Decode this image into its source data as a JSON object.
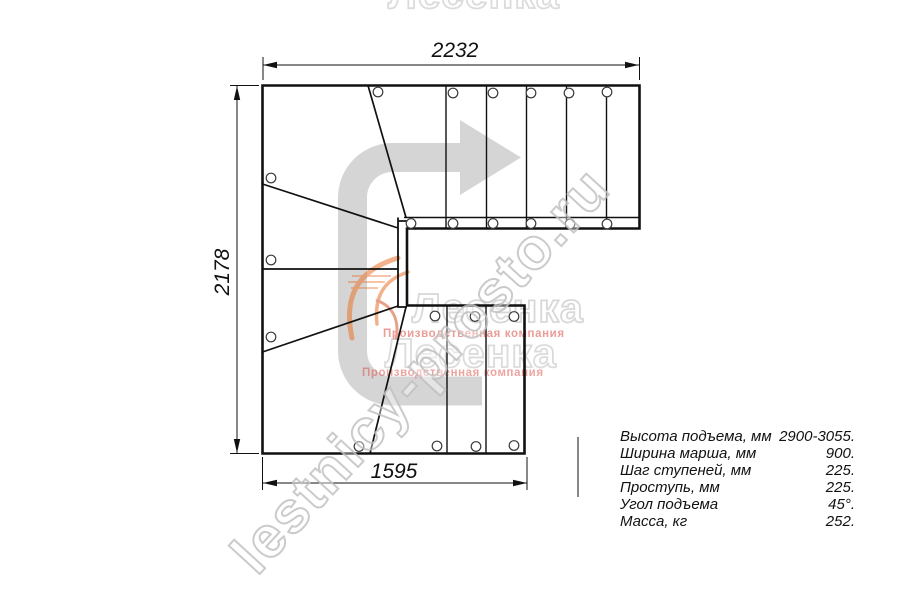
{
  "drawing": {
    "title": "L-shaped staircase plan (top view)",
    "dimensions": {
      "top": "2232",
      "left": "2178",
      "bottom": "1595"
    }
  },
  "specs": {
    "rows": [
      {
        "label": "Высота подъема, мм",
        "value": "2900-3055."
      },
      {
        "label": "Ширина марша, мм",
        "value": "900."
      },
      {
        "label": "Шаг ступеней, мм",
        "value": "225."
      },
      {
        "label": "Проступь, мм",
        "value": "225."
      },
      {
        "label": "Угол подъема",
        "value": "45°."
      },
      {
        "label": "Масса, кг",
        "value": "252."
      }
    ]
  },
  "watermarks": {
    "diagonal_text": "lestnicy-prosto.ru",
    "brand_word": "Лесенка",
    "brand_caption": "Производственная компания"
  },
  "icons": {
    "direction_arrow": "curved-arrow-up-then-right"
  },
  "colors": {
    "line": "#111111",
    "arrow_gray": "#d5d5d5",
    "watermark_outline": "#bcbcbc",
    "caption_red": "#dd4a42",
    "swoosh_orange": "#e8732c"
  }
}
